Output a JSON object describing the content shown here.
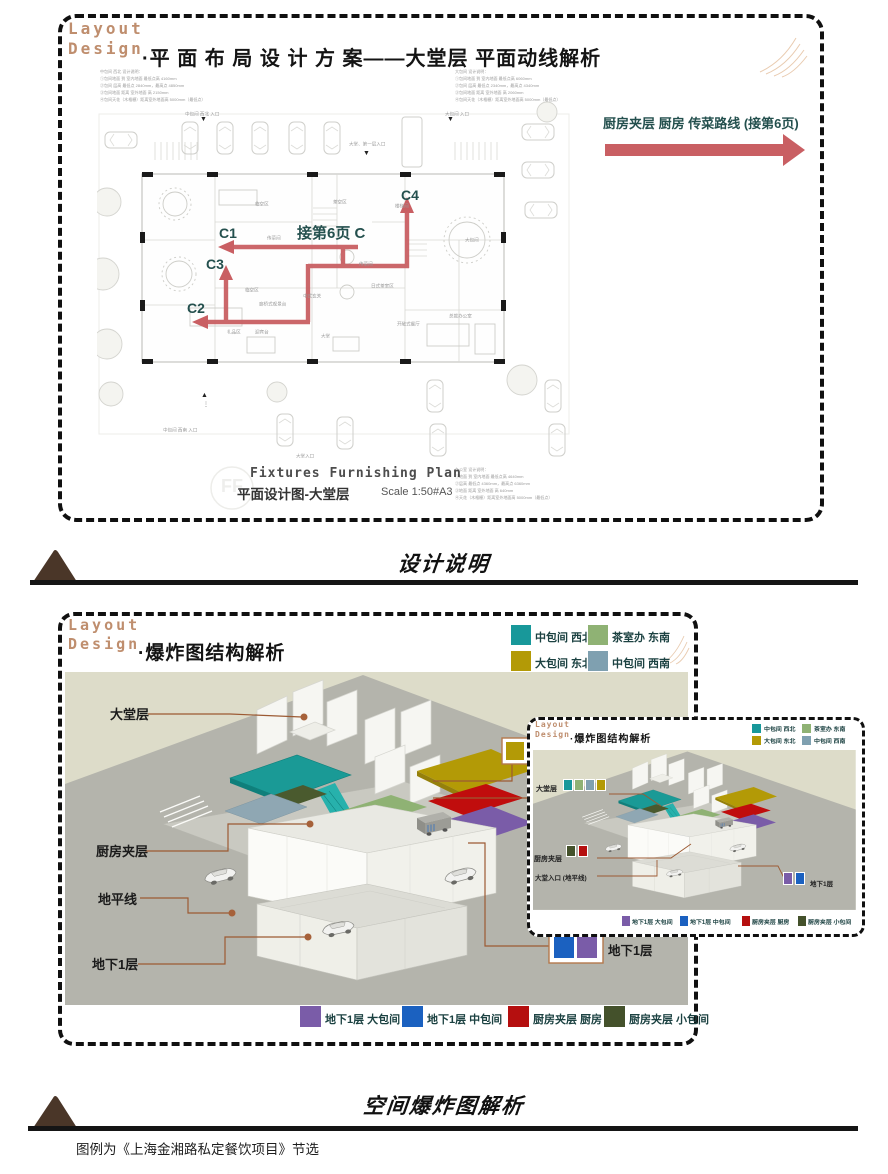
{
  "top_panel": {
    "brand1": "Layout",
    "brand2": "Design",
    "title": "·平 面 布 局 设 计 方 案——大堂层 平面动线解析",
    "route_note": "厨房夹层 厨房 传菜路线 (接第6页)",
    "route_labels": {
      "c1": "C1",
      "c2": "C2",
      "c3": "C3",
      "c4": "C4",
      "mid": "接第6页 C"
    },
    "plan": {
      "notes_nw": [
        "中包间 西北 设计说明：",
        "①包间地面 到 室内地面 最低点高 4160mm",
        "②包间 层高 最低点 2840mm，最高点 4850mm",
        "③包间地面 距离 室外地面 高 2150mm",
        "④包间天花（木格栅）距离室外地面高 5000mm（最低点）"
      ],
      "notes_ne": [
        "大包间 设计说明：",
        "①包间地面 到 室内地面 最低点高 6060mm",
        "②包间 层高 最低点 2340mm，最高点 4340mm",
        "③包间地面 距离 室外地面 高 2060mm",
        "④包间天花（木格栅）距离室外地面高 5000mm（最低点）"
      ],
      "notes_se": [
        "办公室 设计说明：",
        "①地面 到 室内地面 最低点高 4640mm",
        "②层高 最低点 4360mm，最高点 6360mm",
        "③地面 距离 室外地面 高 640mm",
        "④天花（木格栅）距离室外地面高 5000mm（最低点）"
      ],
      "entry_nw": "中包间 西北 入口",
      "entry_ne": "大包间 入口",
      "entry_top": "大堂、第一层入口",
      "entry_sw": "中包间 西南 入口",
      "entry_s": "大堂入口",
      "rooms": [
        "临空区",
        "茶空区",
        "传菜间",
        "传菜间",
        "大包间",
        "临空区",
        "廊桥式观景台",
        "中式玄关",
        "日式茶室区",
        "大堂",
        "礼品区",
        "迎宾台",
        "总裁办公室",
        "开敞式餐厅",
        "楼梯间"
      ],
      "footer_en": "Fixtures Furnishing Plan",
      "footer_zh": "平面设计图-大堂层",
      "footer_scale": "Scale 1:50#A3",
      "watermark": "FF"
    }
  },
  "divider_design": {
    "label": "设计说明"
  },
  "divider_explode": {
    "label": "空间爆炸图解析",
    "caption": "图例为《上海金湘路私定餐饮项目》节选"
  },
  "bottom_panel": {
    "brand1": "Layout",
    "brand2": "Design",
    "title": "·爆炸图结构解析",
    "legend_top": [
      {
        "label": "中包间 西北",
        "color": "#18989a"
      },
      {
        "label": "茶室办 东南",
        "color": "#8fb274"
      },
      {
        "label": "大包间 东北",
        "color": "#b39a06"
      },
      {
        "label": "中包间 西南",
        "color": "#7fa0b0"
      }
    ],
    "layers": {
      "hall": "大堂层",
      "mezz": "厨房夹层",
      "ground": "地平线",
      "b1": "地下1层"
    },
    "b1_tag": "地下1层",
    "legend_bottom": [
      {
        "label": "地下1层 大包间",
        "color": "#7a5ca8"
      },
      {
        "label": "地下1层 中包间",
        "color": "#1b61c0"
      },
      {
        "label": "厨房夹层 厨房",
        "color": "#b50f0f"
      },
      {
        "label": "厨房夹层 小包间",
        "color": "#44512b"
      }
    ],
    "inset": {
      "brand1": "Layout",
      "brand2": "Design",
      "title": "·爆炸图结构解析",
      "labels": {
        "hall": "大堂层",
        "mezz": "厨房夹层",
        "entry": "大堂入口 (地平线)",
        "b1": "地下1层"
      }
    }
  },
  "colors": {
    "route_red": "#c95f63",
    "leader_brown": "#9c5a33",
    "brand_tan": "#bf8e6e",
    "ink_teal": "#24504e",
    "diagram_beige": "#dddcc9",
    "ground_gray": "#b4b4ac"
  }
}
